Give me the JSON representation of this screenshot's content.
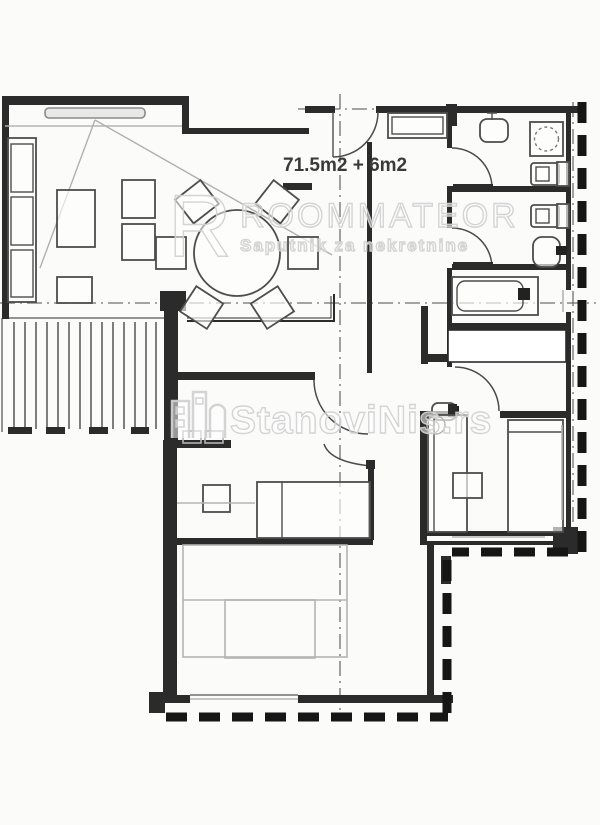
{
  "floorplan": {
    "area_label": "71.5m2 + 6m2",
    "watermarks": {
      "primary": {
        "logo_letter": "R",
        "title": "ROOMMATEOR",
        "subtitle": "Saputnik  za  nekretnine"
      },
      "secondary": {
        "text": "StanoviNis.rs"
      }
    },
    "colors": {
      "background": "#fbfbfa",
      "wall": "#2b2b2b",
      "outer_dashed_wall": "#161616",
      "furniture_outline": "#4d4d4d",
      "light_sketch": "#b4b4b4",
      "section_line": "#6f6f6f",
      "watermark_stroke": "#d2d2d2",
      "label_text": "#3a3a3a"
    }
  }
}
